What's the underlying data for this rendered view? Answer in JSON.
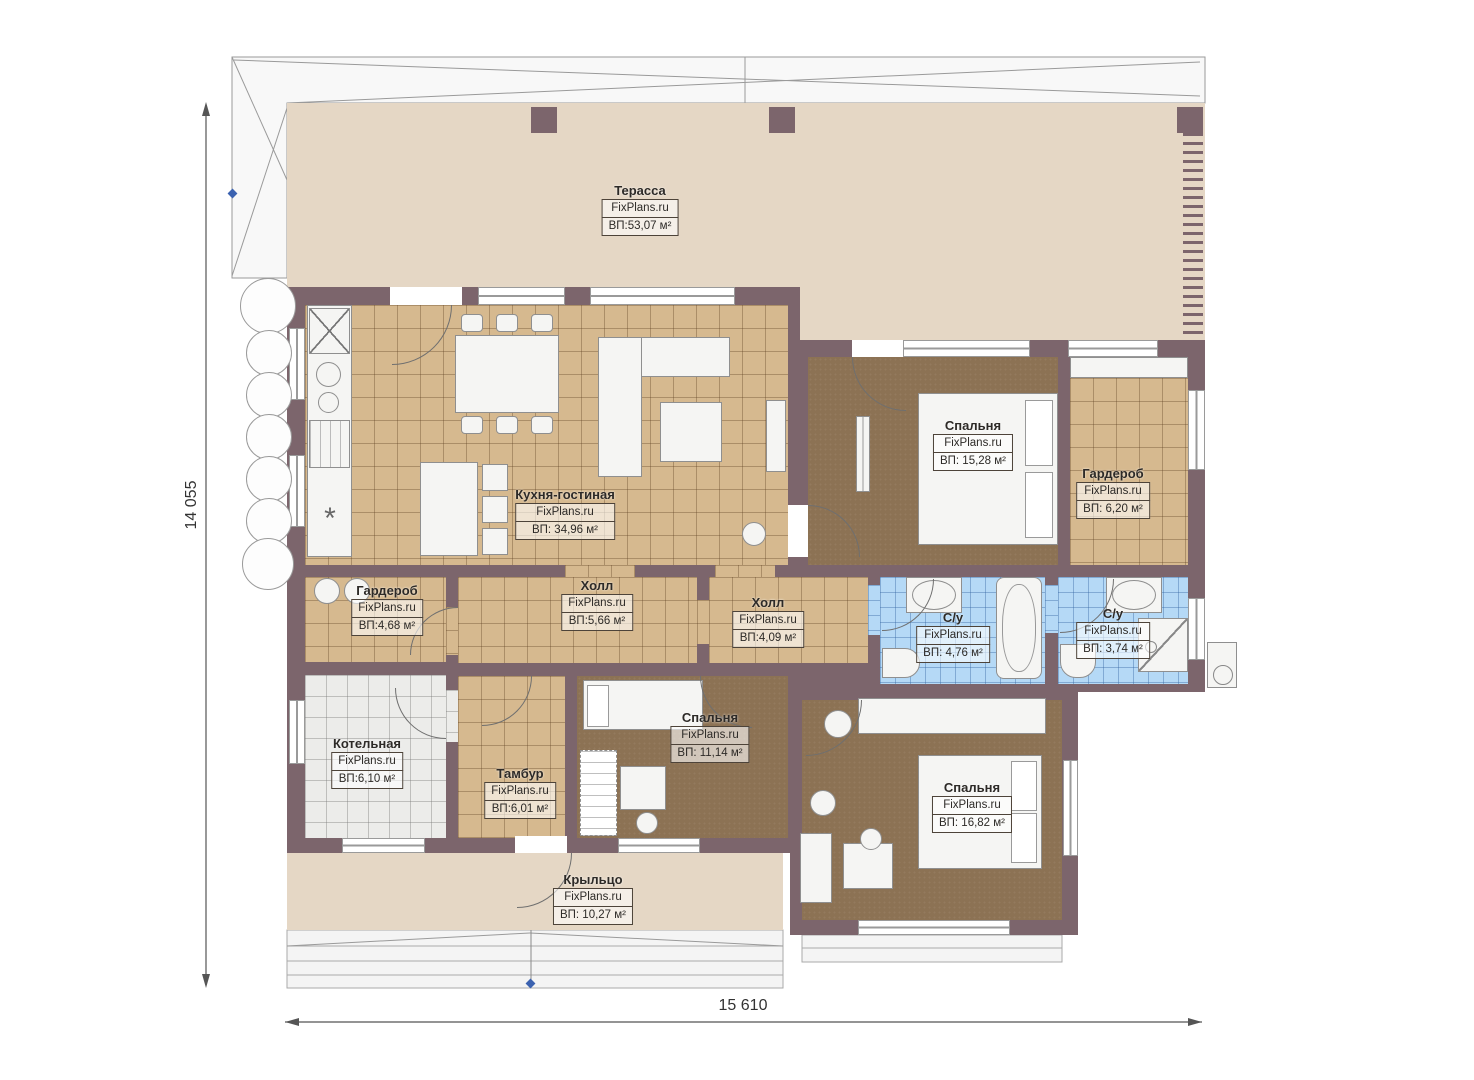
{
  "plan": {
    "watermark": "FixPlans.ru",
    "dimensions": {
      "left": "14 055",
      "bottom": "15 610"
    },
    "rooms": [
      {
        "name": "Терасса",
        "area": "ВП:53,07 м²"
      },
      {
        "name": "Кухня-гостиная",
        "area": "ВП: 34,96 м²"
      },
      {
        "name": "Спальня",
        "area": "ВП: 15,28 м²"
      },
      {
        "name": "Гардероб",
        "area": "ВП: 6,20 м²"
      },
      {
        "name": "Холл",
        "area": "ВП:5,66 м²"
      },
      {
        "name": "Холл",
        "area": "ВП:4,09 м²"
      },
      {
        "name": "С/у",
        "area": "ВП: 4,76 м²"
      },
      {
        "name": "С/у",
        "area": "ВП: 3,74 м²"
      },
      {
        "name": "Гардероб",
        "area": "ВП:4,68 м²"
      },
      {
        "name": "Котельная",
        "area": "ВП:6,10 м²"
      },
      {
        "name": "Тамбур",
        "area": "ВП:6,01 м²"
      },
      {
        "name": "Спальня",
        "area": "ВП: 11,14 м²"
      },
      {
        "name": "Спальня",
        "area": "ВП: 16,82 м²"
      },
      {
        "name": "Крыльцо",
        "area": "ВП: 10,27 м²"
      }
    ],
    "colors": {
      "wall": "#7c656c",
      "terrace": "#e5d7c5",
      "tile": "#d6b98f",
      "bedroom": "#8c7254",
      "bath": "#b5d9f6",
      "boiler": "#ececea"
    }
  }
}
